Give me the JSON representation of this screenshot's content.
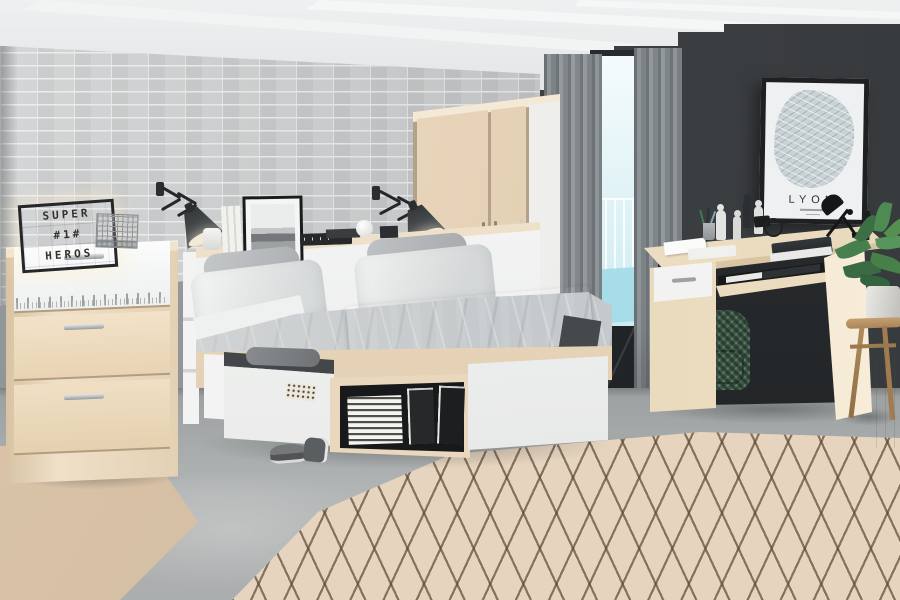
{
  "scene": {
    "description": "Bedroom showroom photo: beech and white furniture set against grey brick wall and charcoal accent wall"
  },
  "lightbox": {
    "line1": "SUPER",
    "line2": "#1#",
    "line3": "HEROS"
  },
  "poster": {
    "title": "LYON"
  },
  "colors": {
    "brick_wall": "#c8cacb",
    "mortar": "#e6e8e9",
    "accent_wall": "#3a3d3f",
    "floor": "#a9acad",
    "wood": "#ecdcc6",
    "wood_dark": "#d9c2a4",
    "white_panel": "#f5f6f5",
    "duvet": "#c2c6c8",
    "blanket": "#54585b",
    "curtain": "#8a9093",
    "rug": "#e6d4bf",
    "rug_line": "#5c4735",
    "backpack": "#3e5747",
    "plant": "#47804e",
    "lightbox_face": "#f7ecd3",
    "frame_black": "#1e2022"
  },
  "objects": [
    "chest of drawers",
    "lightbox sign",
    "wire basket",
    "scissor wall lamps",
    "storage bed with drawers",
    "headboard shelf",
    "framed photo",
    "wardrobe",
    "window with curtains",
    "city map poster",
    "desk with drawer",
    "desk lamp",
    "backpack",
    "plant on stool",
    "diamond pattern rug",
    "sneakers"
  ]
}
